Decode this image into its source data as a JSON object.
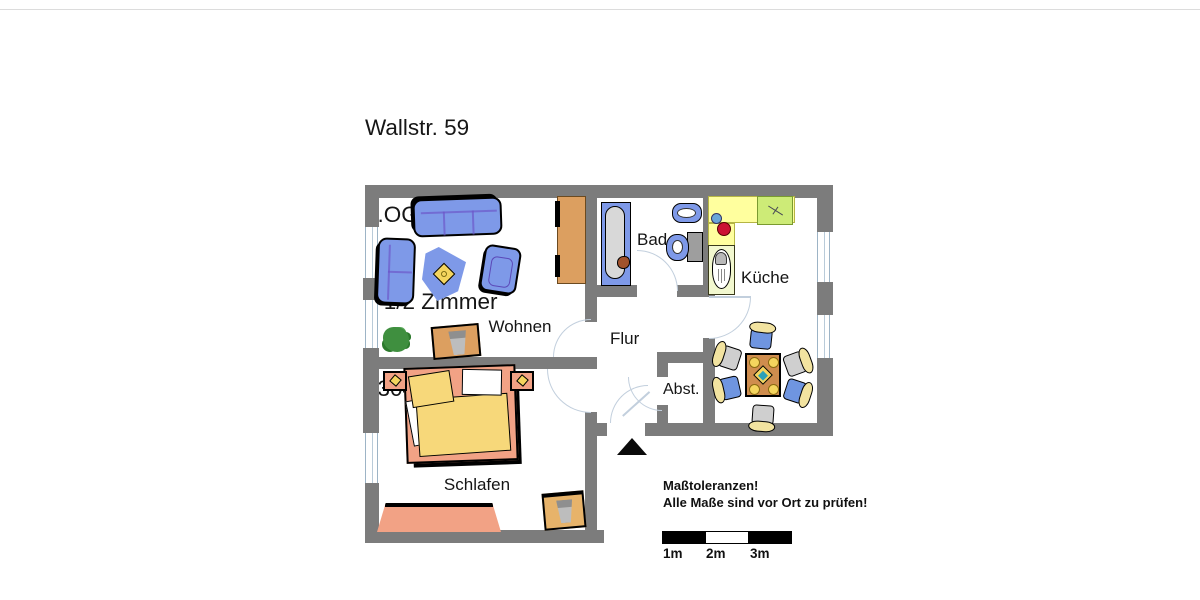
{
  "title": {
    "lines": [
      "Wallstr. 59",
      "1.OG  links",
      "2 1/2 Zimmer",
      "9304-5-27"
    ]
  },
  "rooms": {
    "wohnen": "Wohnen",
    "schlafen": "Schlafen",
    "bad": "Bad",
    "kueche": "Küche",
    "flur": "Flur",
    "abst": "Abst."
  },
  "notes": {
    "line1": "Maßtoleranzen!",
    "line2": "Alle Maße sind vor Ort zu prüfen!"
  },
  "scale": {
    "labels": [
      "1m",
      "2m",
      "3m"
    ]
  },
  "icons": {
    "entrance_marker": "black-triangle-up"
  },
  "colors": {
    "wall": "#7c7c7c",
    "furniture_blue": "#7e99e8",
    "bed_salmon": "#f2a285",
    "duvet_yellow": "#f7d87a",
    "wood_orange": "#dc9f60",
    "kitchen_counter_yellow": "#ffff9e",
    "stove_green": "#cdeb77",
    "sink_counter_green": "#f2f8cf",
    "door_arc": "#c2cfdd",
    "text": "#111111"
  }
}
